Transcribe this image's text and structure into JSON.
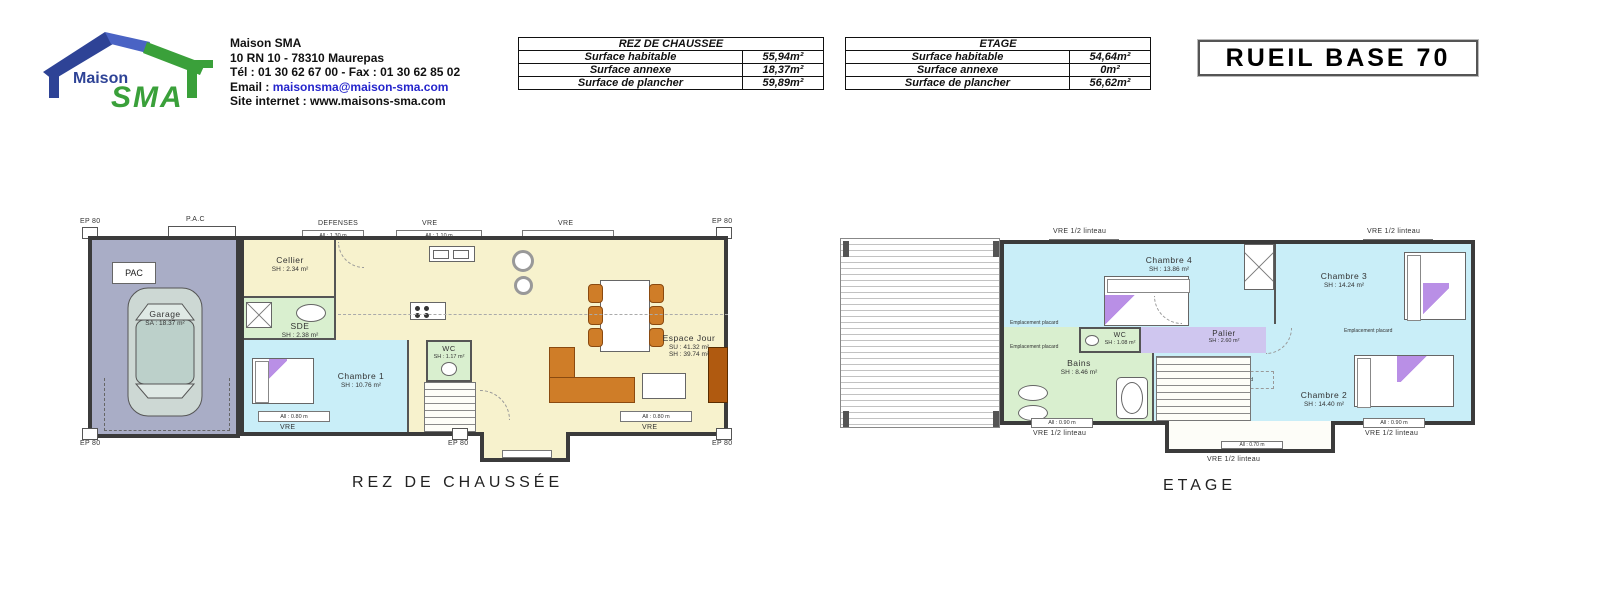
{
  "header": {
    "logo": {
      "brand_top": "Maison",
      "brand_main": "SMA"
    },
    "company": {
      "name": "Maison SMA",
      "address": "10 RN 10 - 78310 Maurepas",
      "phone_fax": "Tél : 01 30 62 67 00 - Fax : 01 30 62 85 02",
      "email_label": "Email : ",
      "email": "maisonsma@maison-sma.com",
      "site_label": "Site internet : ",
      "site": "www.maisons-sma.com"
    },
    "tables": [
      {
        "title": "REZ DE CHAUSSEE",
        "rows": [
          [
            "Surface habitable",
            "55,94m²"
          ],
          [
            "Surface annexe",
            "18,37m²"
          ],
          [
            "Surface de plancher",
            "59,89m²"
          ]
        ]
      },
      {
        "title": "ETAGE",
        "rows": [
          [
            "Surface habitable",
            "54,64m²"
          ],
          [
            "Surface annexe",
            "0m²"
          ],
          [
            "Surface de plancher",
            "56,62m²"
          ]
        ]
      }
    ],
    "plan_title": "RUEIL BASE 70"
  },
  "ground_floor": {
    "caption": "REZ DE CHAUSSÉE",
    "rooms": {
      "garage": {
        "name": "Garage",
        "area": "SA : 18.37 m²"
      },
      "pac_box": "PAC",
      "cellier": {
        "name": "Cellier",
        "area": "SH : 2.34 m²"
      },
      "sde": {
        "name": "SDE",
        "area": "SH : 2.38 m²"
      },
      "chambre1": {
        "name": "Chambre 1",
        "area": "SH : 10.76 m²"
      },
      "wc": {
        "name": "WC",
        "area": "SH : 1.17 m²"
      },
      "espace": {
        "name": "Espace Jour",
        "area_su": "SU : 41.32 m²",
        "area_sh": "SH : 39.74 m²"
      }
    },
    "labels": {
      "ep80": "EP 80",
      "pac_top": "P.A.C",
      "defenses": "DEFENSES",
      "vre": "VRE",
      "win_130": "All : 1.30 m",
      "win_110": "All : 1.10 m",
      "win_080": "All : 0.80 m"
    }
  },
  "etage": {
    "caption": "ETAGE",
    "rooms": {
      "chambre4": {
        "name": "Chambre 4",
        "area": "SH : 13.86 m²"
      },
      "chambre3": {
        "name": "Chambre 3",
        "area": "SH : 14.24 m²"
      },
      "chambre2": {
        "name": "Chambre 2",
        "area": "SH : 14.40 m²"
      },
      "palier": {
        "name": "Palier",
        "area": "SH : 2.60 m²"
      },
      "wc": {
        "name": "WC",
        "area": "SH : 1.08 m²"
      },
      "bains": {
        "name": "Bains",
        "area": "SH : 8.46 m²"
      }
    },
    "labels": {
      "vre_linteau": "VRE 1/2 linteau",
      "win_090": "All : 0.90 m",
      "win_070": "All : 0.70 m",
      "placard": "Emplacement placard"
    }
  },
  "colors": {
    "room_yellow": "#f7f2cd",
    "room_cyan": "#c9eef8",
    "room_green": "#d9efcf",
    "room_lavender": "#cfc6ef",
    "garage_gray": "#a9adc6",
    "wall": "#3b3b3b",
    "furniture_orange": "#cf7d28",
    "accent_purple": "#b98fe6",
    "logo_blue": "#2e4396",
    "logo_green": "#3aa03a",
    "email_blue": "#2525cc"
  }
}
